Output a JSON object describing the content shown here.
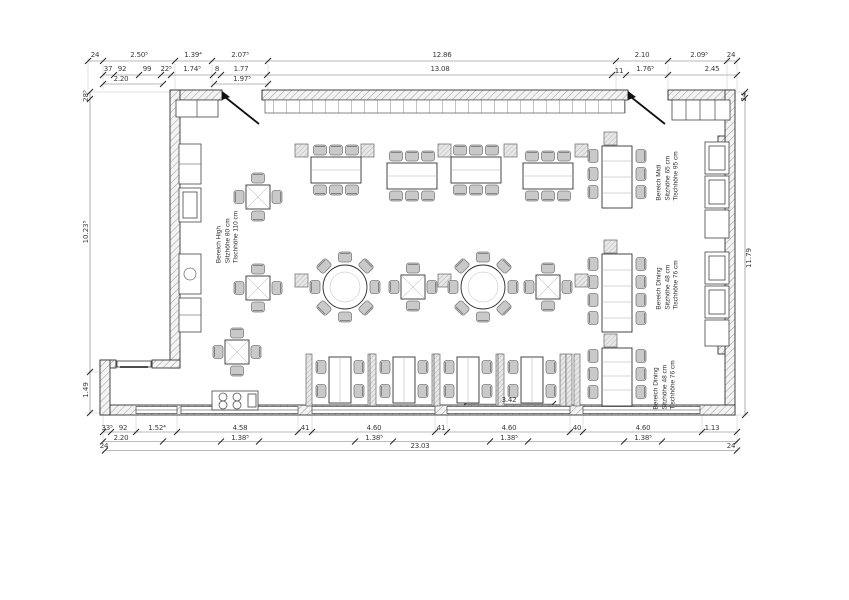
{
  "plan": {
    "areas": [
      {
        "name": "Bereich High",
        "seat_height": "Sitzhöhe 80 cm",
        "table_height": "Tischhöhe 110 cm"
      },
      {
        "name": "Bereich Midi",
        "seat_height": "Sitzhöhe 65 cm",
        "table_height": "Tischhöhe 95 cm"
      },
      {
        "name": "Bereich Dining",
        "seat_height": "Sitzhöhe 48 cm",
        "table_height": "Tischhöhe 76 cm"
      },
      {
        "name": "Bereich Dining",
        "seat_height": "Sitzhöhe 48 cm",
        "table_height": "Tischhöhe 76 cm"
      }
    ],
    "dims": {
      "top_a": [
        "24",
        "2.50⁵",
        "1.39⁴",
        "2.07⁵",
        "12.86",
        "2.10",
        "2.09⁵",
        "24"
      ],
      "top_b": [
        "37",
        "92",
        "99",
        "22⁵",
        "1.74⁵",
        "8",
        "1.77",
        "13.08",
        "11",
        "1.76⁵",
        "2.45"
      ],
      "top_c": [
        "2.20",
        "1.97⁵"
      ],
      "left": [
        "28⁵",
        "10.23⁵",
        "1.49"
      ],
      "right": [
        "24",
        "11.79"
      ],
      "bottom_a": [
        "33⁵",
        "92",
        "1.52⁴",
        "4.58",
        "41",
        "4.60",
        "41",
        "4.60",
        "40",
        "4.60",
        "1.13"
      ],
      "bottom_b": [
        "2.20",
        "1.38⁵",
        "1.38⁵",
        "1.38⁵",
        "1.38⁵"
      ],
      "bottom_c": [
        "24",
        "23.03",
        "24"
      ],
      "interior": [
        "3.42"
      ]
    },
    "colors": {
      "line": "#333333",
      "hatch": "#9a9a9a",
      "chair": "#c9c9c9",
      "text": "#3a3a3a"
    }
  }
}
